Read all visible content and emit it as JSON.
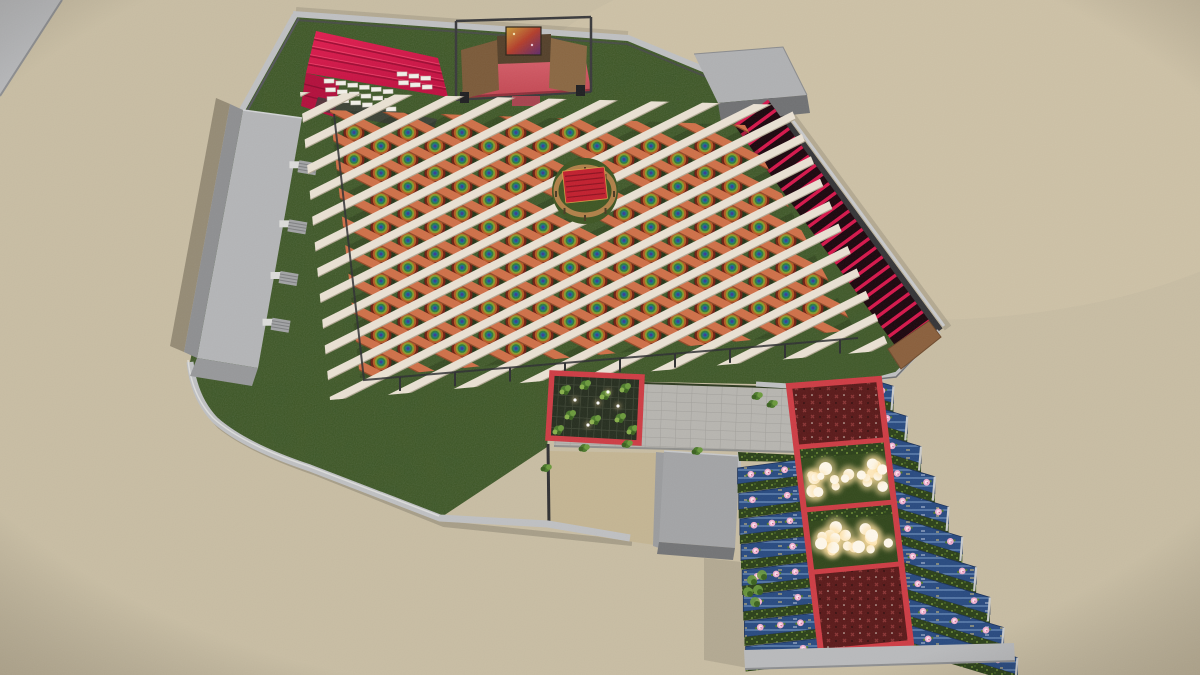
{
  "scene": {
    "type": "3d-architectural-render",
    "view": "aerial-isometric",
    "subject": "walled event venue with diagonal pergola lattice over round dining tables, stage with red canopy seating, central gazebo, red slat wall, paved courtyard with plant pergola, and a pavilion wing with blue floral roofs and festoon lights"
  },
  "palette": {
    "sand": "#c8bda3",
    "sand_shadow": "rgba(55,47,32,0.35)",
    "lawn": "#3e5623",
    "wall_light": "#bfc0c2",
    "wall_mid": "#9a9b9d",
    "wall_dark": "#353537",
    "building_top": "#b4b5b7",
    "building_side": "#8e8f91",
    "beam_cream": "#eae1d3",
    "beam_cream_shadow": "#b3a995",
    "beam_orange": "#cf7048",
    "beam_orange_dark": "#8f4a28",
    "canopy_red": "#e11e50",
    "canopy_red_dark": "#b30f3c",
    "stage_floor": "#d25560",
    "backdrop_brown": "#7b5a39",
    "backdrop_brown2": "#8a6742",
    "truss": "#39393b",
    "fin_red": "#d6164b",
    "fin_gap": "#1c060d",
    "gazebo_ring": "#b08048",
    "gazebo_red": "#c21f2e",
    "table_rings": [
      "#6f2014",
      "#b55a23",
      "#8a9b2e",
      "#2e7d3f",
      "#1f6e8c",
      "#3d3a91"
    ],
    "frame_red": "#ce3c44",
    "paver": "#b7b5b0",
    "paver_line": "#a19f9a",
    "yard_sand": "#c4b593",
    "panel_blue": "#284a80",
    "panel_streak": "#8fb0d8",
    "flower_pink": "#f0aecd",
    "flower_core": "#fbe3ef",
    "hedge_green": "#2b4019",
    "hedge_speckle": "#7fa23b",
    "bed_maroon": "#5a1919",
    "bed_sprig": "#8a3434",
    "bulb_core": "#fff8ea",
    "bulb_halo": "#ffdf9e",
    "plant_green": "#4c7a2c",
    "plant_green_light": "#6b9a3c",
    "plant_green_pale": "#86b04a"
  },
  "params": {
    "lattice": {
      "cream_count": 21,
      "orange_count": 17,
      "spacing": 27,
      "slope": 0.5,
      "cream_width": 7.5,
      "orange_width": 8
    },
    "tables": {
      "radii": [
        10.5,
        8.2,
        6.2,
        4.4,
        2.8,
        1.4
      ]
    },
    "fins": {
      "count": 26
    },
    "canopy": {
      "tier_lines": 4
    },
    "head_tables": {
      "left_rows": 3,
      "left_cols": 6,
      "right_rows": 2,
      "right_cols": 3
    },
    "wing_left": {
      "rows": 8
    },
    "wing_right": {
      "rows": 10
    },
    "festoon_lights": {
      "upper": 20,
      "lower": 18
    },
    "gazebo": {
      "posts": 8
    },
    "stairs": {
      "count": 4
    }
  },
  "elements": {
    "labels": [
      "ground-sand",
      "venue-lawn",
      "perimeter-wall",
      "service-building-left",
      "stairs",
      "stage",
      "stage-backdrop-art",
      "vip-red-canopy",
      "head-table-rows",
      "utility-building",
      "red-slat-wall",
      "pergola-lattice",
      "cream-beam",
      "orange-beam",
      "dining-table",
      "central-gazebo",
      "courtyard-pavement",
      "inner-yard",
      "annex-building",
      "plant-pergola",
      "shrub",
      "pavilion-complex",
      "floral-roof-left-wing",
      "floral-roof-right-wing",
      "flower-bed",
      "festoon-lights",
      "complex-base-wall"
    ]
  }
}
